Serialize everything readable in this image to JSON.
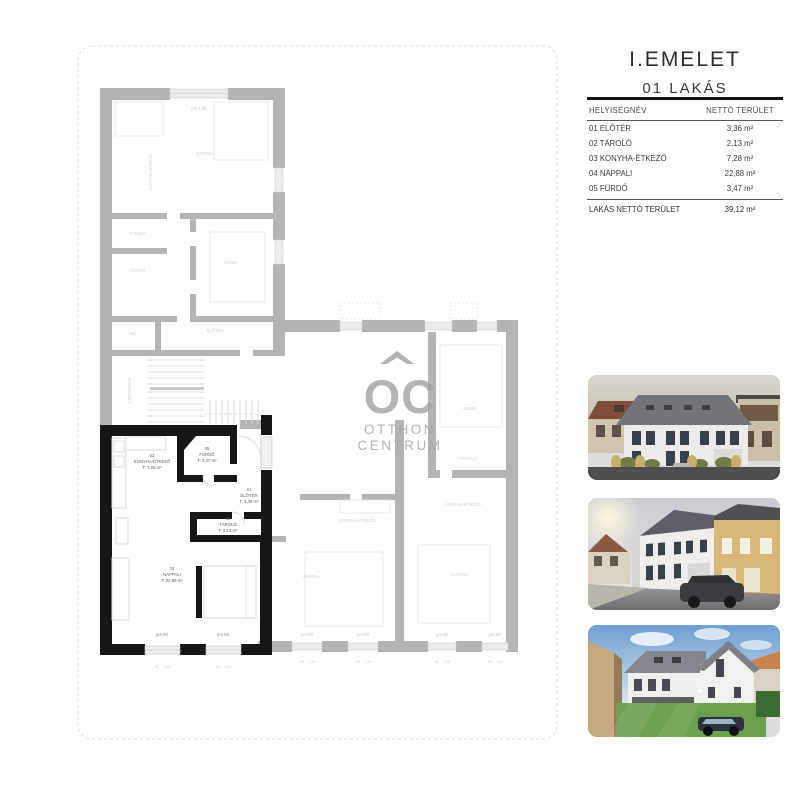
{
  "header": {
    "title": "I.EMELET",
    "subtitle": "01 LAKÁS"
  },
  "table": {
    "col_name": "HELYISÉGNÉV",
    "col_area": "NETTÓ TERÜLET",
    "rows": [
      {
        "name": "01 ELŐTÉR",
        "area": "3,36 m²"
      },
      {
        "name": "02 TÁROLÓ",
        "area": "2,13 m²"
      },
      {
        "name": "03 KONYHA-ÉTKEZŐ",
        "area": "7,28 m²"
      },
      {
        "name": "04 NAPPALI",
        "area": "22,88 m²"
      },
      {
        "name": "05 FÜRDŐ",
        "area": "3,47 m²"
      }
    ],
    "total_label": "LAKÁS NETTÓ TERÜLET",
    "total_value": "39,12 m²"
  },
  "floorplan": {
    "rooms": [
      {
        "num": "03",
        "name": "KONYHA-ÉTKEZŐ",
        "area": "T: 7,28 m²"
      },
      {
        "num": "05",
        "name": "FÜRDŐ",
        "area": "T: 3,47 m²"
      },
      {
        "num": "01",
        "name": "ELŐTÉR",
        "area": "T: 3,36 m²"
      },
      {
        "num": "02",
        "name": "TÁROLÓ",
        "area": "T: 2,13 m²"
      },
      {
        "num": "04",
        "name": "NAPPALI",
        "area": "T: 22,88 m²"
      }
    ],
    "window_label": "pm 90",
    "window_label_top": "pm 1,50",
    "dim_a": "90",
    "dim_b": "1,50",
    "faint": {
      "nappali": "NAPPALI",
      "konyha": "KONYHA-ÉTKEZŐ",
      "tarolo": "TÁROLÓ",
      "furdo": "FÜRDŐ",
      "szoba": "SZOBA",
      "wc": "WC",
      "eloter": "ELŐTÉR",
      "lepcso": "LÉPCSŐHÁZ"
    },
    "watermark": {
      "logo": "OC",
      "line1": "OTTHON",
      "line2": "CENTRUM"
    },
    "colors": {
      "wall_gray": "#b4b4b4",
      "wall_black": "#161616",
      "highlight_label": "#5f5f5f",
      "faint_label": "#d2d2d2",
      "pm_gray": "#c4c4c4",
      "pm_dark": "#8f8f8f",
      "watermark": "#a2a2a2"
    }
  }
}
